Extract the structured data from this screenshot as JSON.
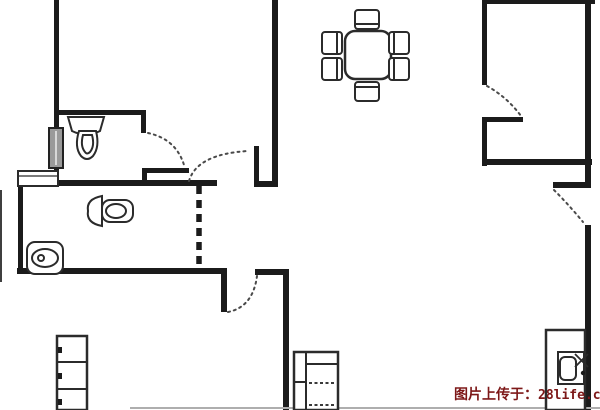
{
  "canvas": {
    "width": 600,
    "height": 410,
    "background": "#ffffff",
    "wall_color": "#1b1b1b",
    "stroke_color": "#2b2b2b",
    "dot_color": "#4a4a4a",
    "faint_color": "#aeaeae",
    "window_fill": "#9a9a9a"
  },
  "watermark": {
    "prefix": "图片上传于：",
    "site": "28life.com",
    "color": "#7d1818"
  },
  "floorplan": {
    "shapes": [
      {
        "n": "left-exterior-wall-upper",
        "t": "wall",
        "x": 54,
        "y": 0,
        "w": 5,
        "h": 130
      },
      {
        "n": "bathroom-top-wall",
        "t": "wall",
        "x": 54,
        "y": 110,
        "w": 92,
        "h": 5
      },
      {
        "n": "bathroom-top-wall-stub",
        "t": "wall",
        "x": 141,
        "y": 110,
        "w": 5,
        "h": 23
      },
      {
        "n": "bathroom-bottom-wall",
        "t": "wall",
        "x": 142,
        "y": 168,
        "w": 47,
        "h": 5
      },
      {
        "n": "bathroom-bottom-wall-stub",
        "t": "wall",
        "x": 142,
        "y": 168,
        "w": 5,
        "h": 15
      },
      {
        "n": "left-exterior-wall-lower",
        "t": "wall",
        "x": 54,
        "y": 166,
        "w": 5,
        "h": 20
      },
      {
        "n": "main-horizontal-wall",
        "t": "wall",
        "x": 17,
        "y": 180,
        "w": 200,
        "h": 6
      },
      {
        "n": "bathroom2-left-wall",
        "t": "wall",
        "x": 18,
        "y": 186,
        "w": 5,
        "h": 87
      },
      {
        "n": "bathroom2-bottom-wall",
        "t": "wall",
        "x": 17,
        "y": 268,
        "w": 210,
        "h": 6
      },
      {
        "n": "hallway-wall-stub",
        "t": "wall",
        "x": 221,
        "y": 274,
        "w": 6,
        "h": 38
      },
      {
        "n": "hallway-wall-right",
        "t": "wall",
        "x": 255,
        "y": 269,
        "w": 34,
        "h": 6
      },
      {
        "n": "living-room-vertical-wall",
        "t": "wall",
        "x": 283,
        "y": 269,
        "w": 6,
        "h": 141
      },
      {
        "n": "door-jamb-stub",
        "t": "wall",
        "x": 254,
        "y": 146,
        "w": 5,
        "h": 40
      },
      {
        "n": "door-jamb-bottom",
        "t": "wall",
        "x": 254,
        "y": 181,
        "w": 24,
        "h": 6
      },
      {
        "n": "center-divider-wall",
        "t": "wall",
        "x": 272,
        "y": 0,
        "w": 6,
        "h": 187
      },
      {
        "n": "top-right-wall",
        "t": "wall",
        "x": 484,
        "y": 0,
        "w": 111,
        "h": 4
      },
      {
        "n": "dining-divider-wall",
        "t": "wall",
        "x": 482,
        "y": 0,
        "w": 5,
        "h": 85
      },
      {
        "n": "kitchen-nook-wall-h",
        "t": "wall",
        "x": 484,
        "y": 117,
        "w": 39,
        "h": 5
      },
      {
        "n": "kitchen-nook-wall-v",
        "t": "wall",
        "x": 482,
        "y": 117,
        "w": 5,
        "h": 49
      },
      {
        "n": "kitchen-bottom-wall",
        "t": "wall",
        "x": 482,
        "y": 159,
        "w": 110,
        "h": 6
      },
      {
        "n": "right-exterior-wall-upper",
        "t": "wall",
        "x": 585,
        "y": 0,
        "w": 6,
        "h": 188
      },
      {
        "n": "right-wall-tick",
        "t": "wall",
        "x": 553,
        "y": 182,
        "w": 38,
        "h": 6
      },
      {
        "n": "right-exterior-wall-lower",
        "t": "wall",
        "x": 585,
        "y": 225,
        "w": 6,
        "h": 185
      },
      {
        "n": "outer-left-line",
        "t": "frect",
        "x": 0,
        "y": 190,
        "w": 2,
        "h": 92,
        "fill": "#3f3f3f"
      },
      {
        "n": "bottom-faint-line",
        "t": "frect",
        "x": 130,
        "y": 407,
        "w": 470,
        "h": 2,
        "fill": "#aeaeae"
      },
      {
        "n": "left-wall-window",
        "t": "frect",
        "x": 49,
        "y": 128,
        "w": 14,
        "h": 40,
        "fill": "#9a9a9a",
        "stroke": true
      },
      {
        "n": "left-wall-window-stripe",
        "t": "line",
        "x1": 56,
        "y1": 131,
        "x2": 56,
        "y2": 165,
        "sw": 2,
        "c": "#d8d8d8"
      },
      {
        "n": "bathroom2-window",
        "t": "rect",
        "x": 18,
        "y": 171,
        "w": 40,
        "h": 15,
        "sw": 2
      },
      {
        "n": "bathroom2-window-line",
        "t": "line",
        "x1": 18,
        "y1": 176,
        "x2": 58,
        "y2": 176,
        "sw": 1.3
      },
      {
        "n": "bathroom2-sliding-door",
        "t": "dashwall",
        "x1": 199,
        "y1": 186,
        "x2": 199,
        "y2": 268
      },
      {
        "n": "bathroom-door-arc",
        "t": "dotarc",
        "d": "M 148 133 Q 176 139 184 165"
      },
      {
        "n": "hall-door-arc",
        "t": "dotarc",
        "d": "M 189 181 Q 197 154 248 151"
      },
      {
        "n": "dining-door-arc",
        "t": "dotarc",
        "d": "M 487 86 Q 507 97 521 116"
      },
      {
        "n": "balcony-door-arc",
        "t": "dotarc",
        "d": "M 554 190 Q 569 205 583 222"
      },
      {
        "n": "living-door-arc",
        "t": "dotarc",
        "d": "M 228 312 Q 253 307 257 276"
      },
      {
        "n": "toilet-tank",
        "t": "path",
        "d": "M 68 117 L 104 117 L 100 131 Q 86 138 72 131 Z"
      },
      {
        "n": "toilet-bowl",
        "t": "path",
        "d": "M 79 131 L 96 131 Q 100 147 93 156 Q 87 162 81 156 Q 74 147 79 131 Z"
      },
      {
        "n": "toilet-bowl-inner",
        "t": "path",
        "d": "M 83 135 L 92 135 Q 95 146 90 152 Q 87 155 85 152 Q 80 146 83 135 Z"
      },
      {
        "n": "toilet2-tank",
        "t": "path",
        "d": "M 102 196 Q 86 199 88 211 Q 86 223 102 226 Z"
      },
      {
        "n": "toilet2-bowl",
        "t": "rrect",
        "x": 102,
        "y": 200,
        "w": 31,
        "h": 22,
        "r": 8
      },
      {
        "n": "toilet2-bowl-inner",
        "t": "ellipse",
        "cx": 116,
        "cy": 211,
        "rx": 10,
        "ry": 7
      },
      {
        "n": "sink-basin",
        "t": "rrect",
        "x": 27,
        "y": 242,
        "w": 36,
        "h": 32,
        "r": 8
      },
      {
        "n": "sink-bowl",
        "t": "ellipse",
        "cx": 45,
        "cy": 258,
        "rx": 13,
        "ry": 9
      },
      {
        "n": "sink-drain",
        "t": "circle",
        "cx": 41,
        "cy": 258,
        "r": 3
      },
      {
        "n": "dining-table",
        "t": "rrect",
        "x": 345,
        "y": 31,
        "w": 46,
        "h": 48,
        "r": 10,
        "sw": 2.5
      },
      {
        "n": "dining-chair-top",
        "t": "rrect",
        "x": 355,
        "y": 10,
        "w": 24,
        "h": 19,
        "r": 3
      },
      {
        "n": "dining-chair-top-back",
        "t": "line",
        "x1": 356,
        "y1": 24,
        "x2": 378,
        "y2": 24
      },
      {
        "n": "dining-chair-bottom",
        "t": "rrect",
        "x": 355,
        "y": 82,
        "w": 24,
        "h": 19,
        "r": 3
      },
      {
        "n": "dining-chair-bottom-back",
        "t": "line",
        "x1": 356,
        "y1": 87,
        "x2": 378,
        "y2": 87
      },
      {
        "n": "dining-chair-left-1",
        "t": "rrect",
        "x": 322,
        "y": 32,
        "w": 20,
        "h": 22,
        "r": 3
      },
      {
        "n": "dining-chair-left-1-back",
        "t": "line",
        "x1": 337,
        "y1": 33,
        "x2": 337,
        "y2": 53
      },
      {
        "n": "dining-chair-left-2",
        "t": "rrect",
        "x": 322,
        "y": 58,
        "w": 20,
        "h": 22,
        "r": 3
      },
      {
        "n": "dining-chair-left-2-back",
        "t": "line",
        "x1": 337,
        "y1": 59,
        "x2": 337,
        "y2": 79
      },
      {
        "n": "dining-chair-right-1",
        "t": "rrect",
        "x": 389,
        "y": 32,
        "w": 20,
        "h": 22,
        "r": 3
      },
      {
        "n": "dining-chair-right-1-back",
        "t": "line",
        "x1": 394,
        "y1": 33,
        "x2": 394,
        "y2": 53
      },
      {
        "n": "dining-chair-right-2",
        "t": "rrect",
        "x": 389,
        "y": 58,
        "w": 20,
        "h": 22,
        "r": 3
      },
      {
        "n": "dining-chair-right-2-back",
        "t": "line",
        "x1": 394,
        "y1": 59,
        "x2": 394,
        "y2": 79
      },
      {
        "n": "cabinet",
        "t": "rect",
        "x": 57,
        "y": 336,
        "w": 30,
        "h": 74,
        "sw": 2.5
      },
      {
        "n": "cabinet-shelf-1",
        "t": "line",
        "x1": 57,
        "y1": 362,
        "x2": 87,
        "y2": 362,
        "sw": 2
      },
      {
        "n": "cabinet-shelf-2",
        "t": "line",
        "x1": 57,
        "y1": 389,
        "x2": 87,
        "y2": 389,
        "sw": 2
      },
      {
        "n": "cabinet-handle-1",
        "t": "frect",
        "x": 58,
        "y": 347,
        "w": 4,
        "h": 6,
        "fill": "#1b1b1b"
      },
      {
        "n": "cabinet-handle-2",
        "t": "frect",
        "x": 58,
        "y": 373,
        "w": 4,
        "h": 6,
        "fill": "#1b1b1b"
      },
      {
        "n": "cabinet-handle-3",
        "t": "frect",
        "x": 58,
        "y": 399,
        "w": 4,
        "h": 6,
        "fill": "#1b1b1b"
      },
      {
        "n": "bed",
        "t": "rect",
        "x": 294,
        "y": 352,
        "w": 44,
        "h": 58,
        "sw": 2.5
      },
      {
        "n": "bed-side-line",
        "t": "line",
        "x1": 306,
        "y1": 352,
        "x2": 306,
        "y2": 410,
        "sw": 2
      },
      {
        "n": "bed-pillow-line",
        "t": "line",
        "x1": 306,
        "y1": 364,
        "x2": 338,
        "y2": 364,
        "sw": 2
      },
      {
        "n": "bed-side-divider",
        "t": "line",
        "x1": 294,
        "y1": 382,
        "x2": 306,
        "y2": 382,
        "sw": 2
      },
      {
        "n": "bed-dash-row-1",
        "t": "dashrow",
        "x1": 309,
        "y1": 383,
        "x2": 336,
        "y2": 383
      },
      {
        "n": "bed-dash-row-2",
        "t": "dashrow",
        "x1": 309,
        "y1": 405,
        "x2": 336,
        "y2": 405
      },
      {
        "n": "tv-cabinet",
        "t": "rect",
        "x": 546,
        "y": 330,
        "w": 39,
        "h": 80,
        "sw": 2.5
      },
      {
        "n": "tv-body",
        "t": "rect",
        "x": 558,
        "y": 352,
        "w": 26,
        "h": 32,
        "sw": 2
      },
      {
        "n": "tv-screen",
        "t": "rrect",
        "x": 560,
        "y": 357,
        "w": 16,
        "h": 23,
        "r": 5,
        "sw": 2
      },
      {
        "n": "tv-antenna-line-1",
        "t": "line",
        "x1": 575,
        "y1": 367,
        "x2": 588,
        "y2": 354,
        "sw": 1.8
      },
      {
        "n": "tv-antenna-line-2",
        "t": "line",
        "x1": 575,
        "y1": 354,
        "x2": 588,
        "y2": 367,
        "sw": 1.8
      },
      {
        "n": "tv-knob",
        "t": "circle",
        "cx": 583,
        "cy": 373,
        "r": 2.2,
        "fill": "#1b1b1b"
      }
    ]
  }
}
